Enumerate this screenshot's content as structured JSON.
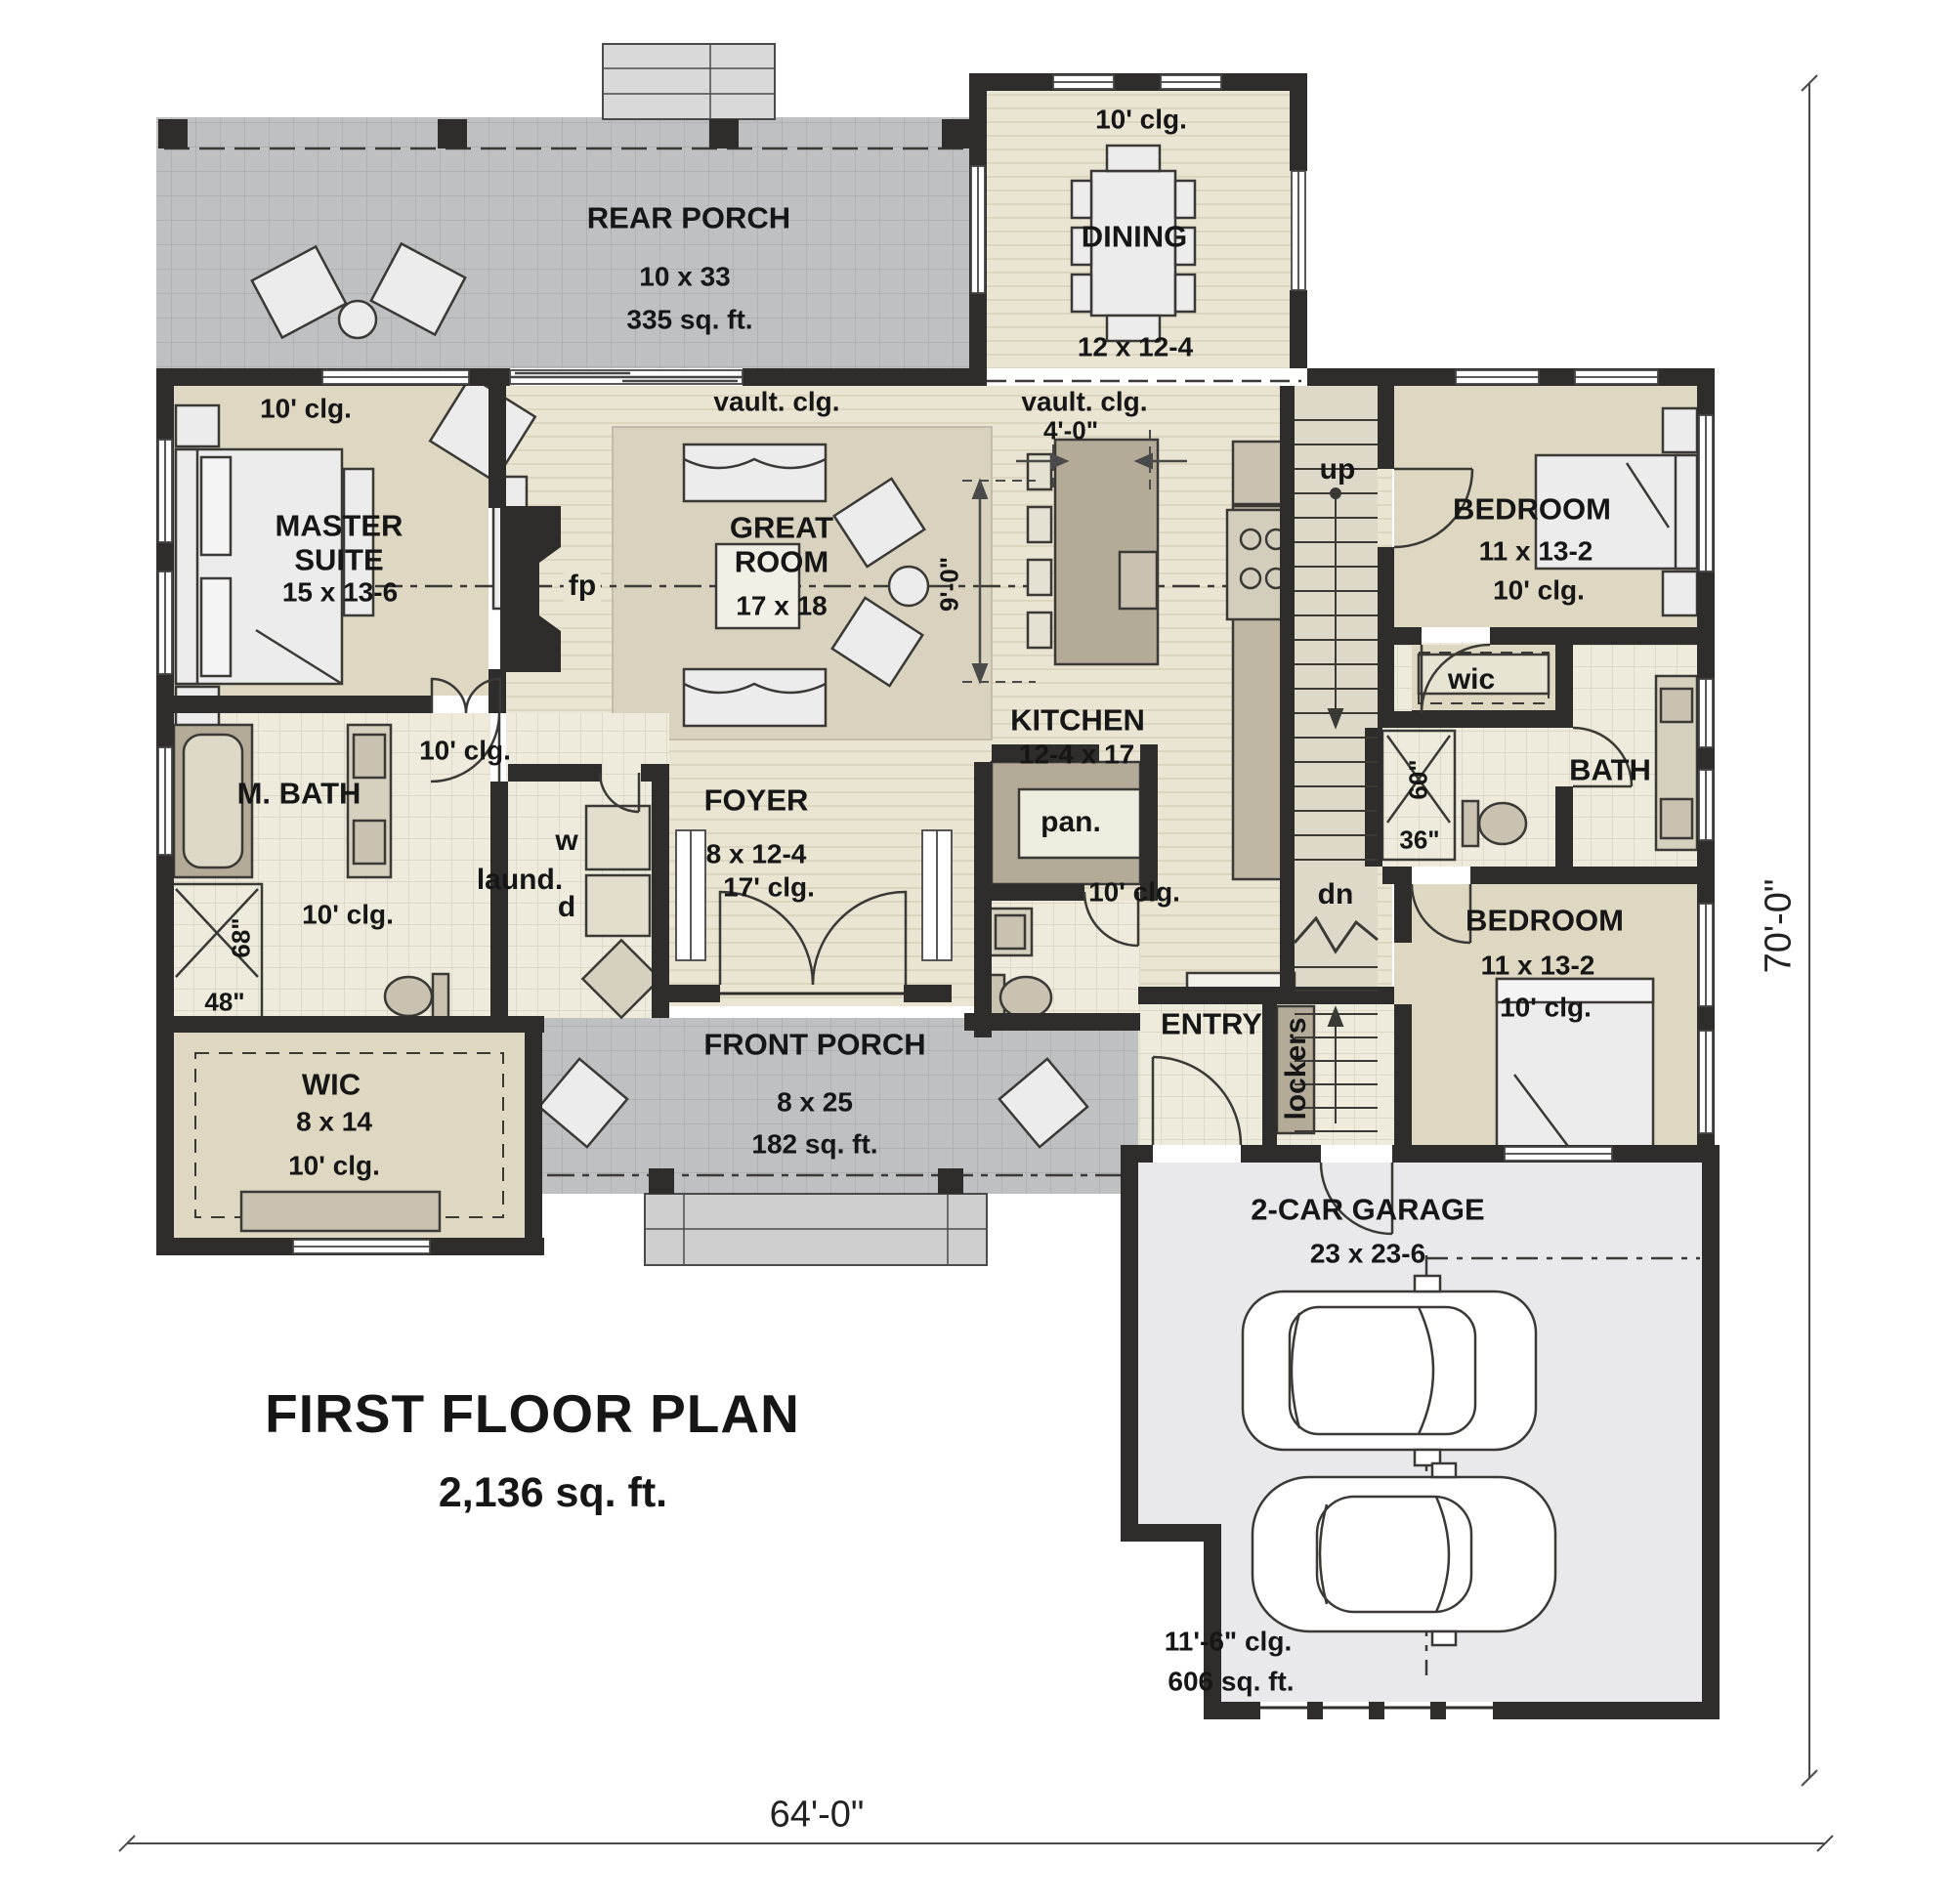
{
  "plan": {
    "title": "FIRST FLOOR PLAN",
    "area": "2,136 sq. ft.",
    "width_dim": "64'-0\"",
    "height_dim": "70'-0\""
  },
  "rooms": {
    "rear_porch": {
      "name": "REAR PORCH",
      "size": "10 x 33",
      "area": "335 sq. ft."
    },
    "dining": {
      "ceiling": "10' clg.",
      "name": "DINING",
      "size": "12 x 12-4"
    },
    "master_suite": {
      "ceiling": "10' clg.",
      "name": "MASTER SUITE",
      "size": "15 x 13-6"
    },
    "great_room": {
      "ceiling": "vault. clg.",
      "name": "GREAT ROOM",
      "size": "17 x 18"
    },
    "kitchen": {
      "ceiling": "vault. clg.",
      "name": "KITCHEN",
      "size": "12-4 x 17",
      "island_width": "4'-0\"",
      "island_length": "9'-0\""
    },
    "bedroom_upper": {
      "name": "BEDROOM",
      "size": "11 x 13-2",
      "ceiling": "10' clg."
    },
    "bedroom_lower": {
      "name": "BEDROOM",
      "size": "11 x 13-2",
      "ceiling": "10' clg."
    },
    "wic_bedroom": {
      "name": "wic"
    },
    "bath": {
      "name": "BATH",
      "shower_length": "60\"",
      "shower_width": "36\""
    },
    "master_bath": {
      "name": "M. BATH",
      "ceiling": "10' clg.",
      "shower_length": "68\"",
      "shower_width": "48\""
    },
    "hall_rear": {
      "ceiling": "10' clg."
    },
    "hall_stair": {
      "ceiling": "10' clg."
    },
    "laundry": {
      "name": "laund.",
      "washer": "w",
      "dryer": "d"
    },
    "foyer": {
      "name": "FOYER",
      "size": "8 x 12-4",
      "ceiling": "17' clg."
    },
    "pantry": {
      "name": "pan."
    },
    "entry": {
      "name": "ENTRY",
      "lockers": "lockers"
    },
    "wic_master": {
      "name": "WIC",
      "size": "8 x 14",
      "ceiling": "10' clg."
    },
    "front_porch": {
      "name": "FRONT PORCH",
      "size": "8 x 25",
      "area": "182 sq. ft."
    },
    "garage": {
      "name": "2-CAR GARAGE",
      "size": "23 x 23-6",
      "ceiling": "11'-6\" clg.",
      "area": "606 sq. ft."
    }
  },
  "stairs": {
    "up": "up",
    "down": "dn"
  },
  "fireplace": {
    "label": "fp"
  },
  "colors": {
    "wall": "#2e2d2b",
    "wood_floor": "#eae4d2",
    "tile_floor": "#eeebdc",
    "carpet_floor": "#ded7c1",
    "porch_floor": "#bfc0c2",
    "garage_floor": "#e9e9eb",
    "counter": "#b3ab98"
  }
}
